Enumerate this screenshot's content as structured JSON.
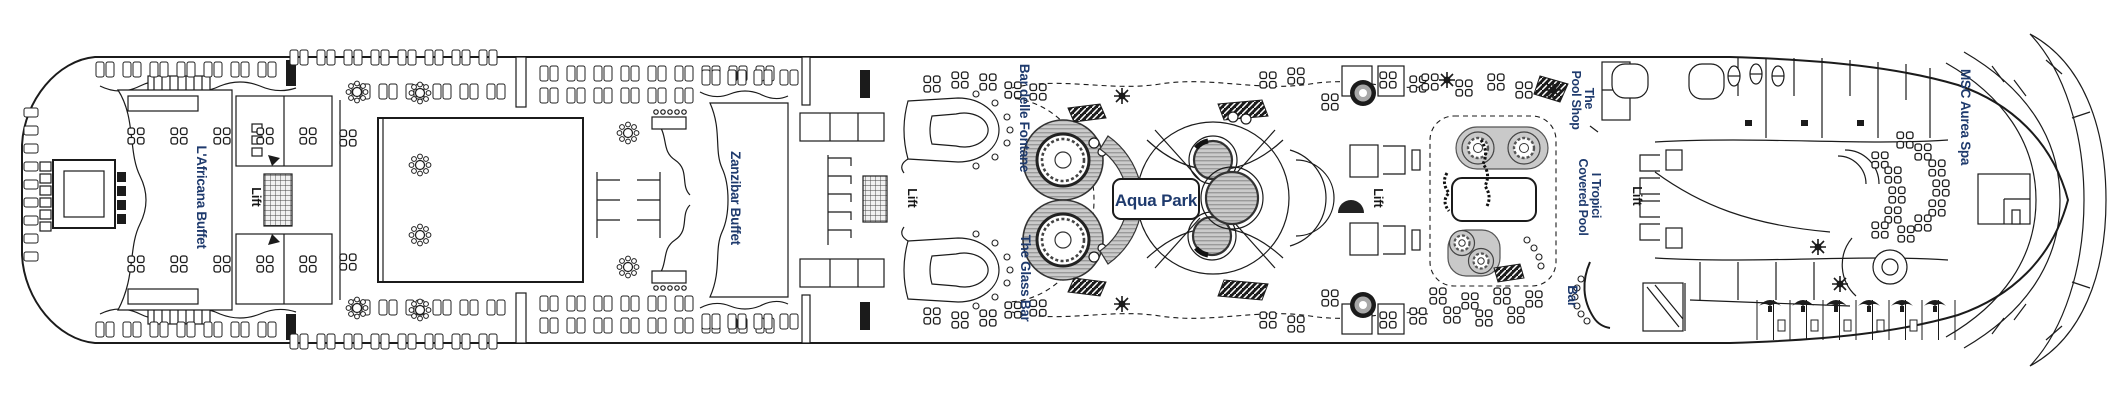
{
  "plan": {
    "type": "cruise-ship-deck-plan",
    "labels": {
      "africana_buffet": "L'Africana Buffet",
      "lift": "Lift",
      "zanzibar_buffet": "Zanzibar Buffet",
      "bar_delle_fontane": "Bar delle Fontane",
      "the_glass_bar": "The Glass Bar",
      "aqua_park": "Aqua Park",
      "the_pool_shop_line1": "The",
      "the_pool_shop_line2": "Pool Shop",
      "i_tropici_line1": "I Tropici",
      "i_tropici_line2": "Covered Pool",
      "bar": "Bar",
      "msc_aurea_spa": "MSC Aurea Spa"
    },
    "colors": {
      "label_navy": "#1e3a6d",
      "lift_text": "#161616",
      "line": "#1b1b1b",
      "pool_fill": "#cbcbcb",
      "pool_hatch": "#9a9a9a",
      "background": "#ffffff"
    }
  }
}
